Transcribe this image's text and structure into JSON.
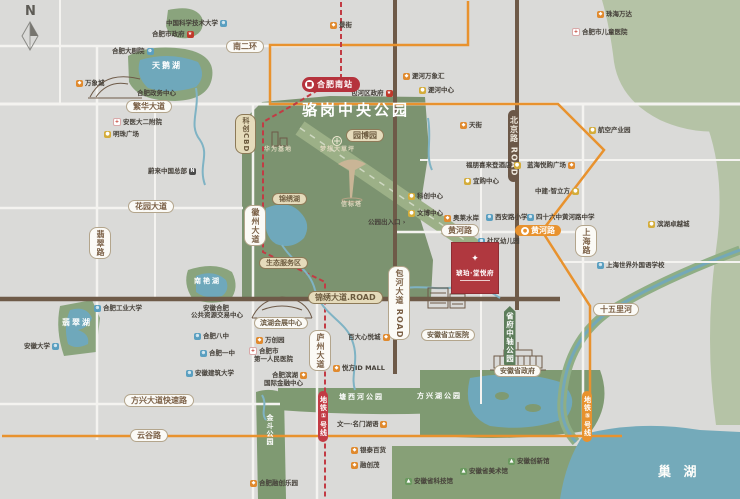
{
  "compass": {
    "letter": "N"
  },
  "station": {
    "name": "合肥南站"
  },
  "project": {
    "name": "琥珀·堂悦府"
  },
  "metro": {
    "line1_label": "地铁①号线",
    "line5_label": "地铁⑤号线"
  },
  "colors": {
    "background": "#dadad8",
    "park_green": "#7c9370",
    "light_green": "#b5c3a6",
    "water_teal": "#6fa8bb",
    "road_brown": "#6e5a48",
    "road_white": "#f4f3f0",
    "metro_red": "#c23b44",
    "metro_orange": "#e8922e",
    "badge_red": "#b5323c"
  },
  "labels": [
    {
      "name": "park-title-luogang",
      "kind": "park-title",
      "text": "骆岗中央公园",
      "x": 302,
      "y": 103
    },
    {
      "name": "lake-name-swan",
      "kind": "water",
      "text": "天鹅湖",
      "x": 152,
      "y": 62
    },
    {
      "name": "lake-name-feicui",
      "kind": "water",
      "text": "翡翠湖",
      "x": 62,
      "y": 319
    },
    {
      "name": "lake-name-nanyan",
      "kind": "water",
      "text": "南艳湖",
      "x": 194,
      "y": 278,
      "fs": 7
    },
    {
      "name": "lake-name-chaohu",
      "kind": "water-big",
      "text": "巢 湖",
      "x": 658,
      "y": 466
    },
    {
      "name": "park-name-tangxihe",
      "kind": "water",
      "text": "塘西河公园",
      "x": 339,
      "y": 394,
      "fs": 7
    },
    {
      "name": "park-name-fangxinghu",
      "kind": "water",
      "text": "方兴湖公园",
      "x": 417,
      "y": 393,
      "fs": 7
    },
    {
      "name": "park-name-jindou",
      "kind": "water",
      "text": "金斗公园",
      "x": 266,
      "y": 414,
      "fs": 7,
      "vert": true
    },
    {
      "name": "road-badge-south-2nd-ring",
      "kind": "pill",
      "text": "南二环",
      "x": 226,
      "y": 40
    },
    {
      "name": "road-badge-fanhua-ave",
      "kind": "pill",
      "text": "繁华大道",
      "x": 126,
      "y": 100
    },
    {
      "name": "road-badge-huayuan-ave",
      "kind": "pill",
      "text": "花园大道",
      "x": 128,
      "y": 200
    },
    {
      "name": "road-badge-fangxing-expwy",
      "kind": "pill",
      "text": "方兴大道快速路",
      "x": 124,
      "y": 394
    },
    {
      "name": "road-badge-yungu-rd",
      "kind": "pill",
      "text": "云谷路",
      "x": 130,
      "y": 429
    },
    {
      "name": "road-badge-huanghe-rd",
      "kind": "pill",
      "text": "黄河路",
      "x": 441,
      "y": 224
    },
    {
      "name": "road-badge-shiwuli-river",
      "kind": "pill",
      "text": "十五里河",
      "x": 593,
      "y": 303
    },
    {
      "name": "road-badge-jinxiu-ave",
      "kind": "pill-tan",
      "text": "锦绣大道.ROAD",
      "x": 308,
      "y": 291
    },
    {
      "name": "station-badge-huanghe-rd",
      "kind": "pill-org-h",
      "text": "黄河路",
      "x": 515,
      "y": 225
    },
    {
      "name": "road-badge-feicui-rd",
      "kind": "pill",
      "text": "翡翠路",
      "x": 89,
      "y": 227,
      "vert": true
    },
    {
      "name": "road-badge-huizhou-ave",
      "kind": "pill",
      "text": "徽州大道",
      "x": 244,
      "y": 205,
      "vert": true
    },
    {
      "name": "road-badge-luzhou-ave",
      "kind": "pill",
      "text": "庐州大道",
      "x": 309,
      "y": 330,
      "vert": true
    },
    {
      "name": "road-badge-baohe-ave",
      "kind": "pill",
      "text": "包河大道 ROAD",
      "x": 388,
      "y": 266,
      "vert": true
    },
    {
      "name": "road-badge-beijing-rd",
      "kind": "pill-dark",
      "text": "北京路 ROAD",
      "x": 508,
      "y": 110,
      "vert": true
    },
    {
      "name": "road-badge-shanghai-rd",
      "kind": "pill",
      "text": "上海路",
      "x": 575,
      "y": 225,
      "vert": true
    },
    {
      "name": "area-badge-kechuang-cbd",
      "kind": "pill-tan",
      "text": "科创CBD",
      "x": 235,
      "y": 114,
      "vert": true,
      "fs": 7
    },
    {
      "name": "area-badge-yuanboyuan",
      "kind": "pill-tan",
      "text": "园博园",
      "x": 346,
      "y": 129
    },
    {
      "name": "area-badge-jinxiu-lake",
      "kind": "pill-tan",
      "text": "锦绣湖",
      "x": 272,
      "y": 193,
      "fs": 7
    },
    {
      "name": "area-badge-eco-service",
      "kind": "pill-tan",
      "text": "生态服务区",
      "x": 259,
      "y": 257,
      "fs": 7
    },
    {
      "name": "area-badge-shengfu-axis-park",
      "kind": "pill-green",
      "text": "省府中轴公园",
      "x": 504,
      "y": 306,
      "vert": true
    },
    {
      "name": "metro-line1-label",
      "kind": "pill-red",
      "text": "地铁①号线",
      "x": 318,
      "y": 391,
      "vert": true
    },
    {
      "name": "metro-line5-label",
      "kind": "pill-org",
      "text": "地铁⑤号线",
      "x": 582,
      "y": 391,
      "vert": true
    },
    {
      "name": "lm-binhu-expo-center",
      "kind": "lm-pill",
      "text": "滨湖会展中心",
      "x": 254,
      "y": 317
    },
    {
      "name": "lm-anhui-provincial-hospital",
      "kind": "lm-pill",
      "text": "安徽省立医院",
      "x": 421,
      "y": 329
    },
    {
      "name": "lm-anhui-provincial-gov",
      "kind": "lm-pill",
      "text": "安徽省政府",
      "x": 494,
      "y": 365
    },
    {
      "name": "poi-ustc",
      "kind": "poi",
      "text": "中国科学技术大学",
      "x": 166,
      "y": 20,
      "icon": "school",
      "side": "right"
    },
    {
      "name": "poi-hefei-city-gov",
      "kind": "poi",
      "text": "合肥市政府",
      "x": 152,
      "y": 31,
      "icon": "gov",
      "side": "right"
    },
    {
      "name": "poi-hefei-grand-theater",
      "kind": "poi",
      "text": "合肥大剧院",
      "x": 112,
      "y": 48,
      "icon": "school",
      "side": "right"
    },
    {
      "name": "poi-mixc-mall",
      "kind": "poi",
      "text": "万象城",
      "x": 76,
      "y": 80,
      "icon": "shop"
    },
    {
      "name": "poi-hefei-gov-center",
      "kind": "poi",
      "text": "合肥政务中心",
      "x": 137,
      "y": 90
    },
    {
      "name": "poi-anyi-2nd-hospital",
      "kind": "poi",
      "text": "安医大二附院",
      "x": 113,
      "y": 118,
      "icon": "hospital"
    },
    {
      "name": "poi-mingzhu-square",
      "kind": "poi",
      "text": "明珠广场",
      "x": 104,
      "y": 131,
      "icon": "biz"
    },
    {
      "name": "poi-nio-china-hq",
      "kind": "poi",
      "text": "蔚来中国总部",
      "x": 148,
      "y": 168,
      "icon": "nio",
      "side": "right"
    },
    {
      "name": "poi-jing-street",
      "kind": "poi",
      "text": "景街",
      "x": 330,
      "y": 22,
      "icon": "shop"
    },
    {
      "name": "poi-feihe-mixc",
      "kind": "poi",
      "text": "淝河万象汇",
      "x": 403,
      "y": 73,
      "icon": "shop"
    },
    {
      "name": "poi-feihe-center",
      "kind": "poi",
      "text": "淝河中心",
      "x": 419,
      "y": 87,
      "icon": "biz"
    },
    {
      "name": "poi-baohe-district-gov",
      "kind": "poi",
      "text": "包河区政府",
      "x": 351,
      "y": 90,
      "icon": "gov",
      "side": "right"
    },
    {
      "name": "poi-zhuhai-wanda",
      "kind": "poi",
      "text": "珠海万达",
      "x": 597,
      "y": 11,
      "icon": "shop"
    },
    {
      "name": "poi-children-hospital",
      "kind": "poi",
      "text": "合肥市儿童医院",
      "x": 572,
      "y": 28,
      "icon": "hospital"
    },
    {
      "name": "poi-tianjie-mall",
      "kind": "poi",
      "text": "天街",
      "x": 460,
      "y": 122,
      "icon": "shop"
    },
    {
      "name": "poi-aviation-industry-park",
      "kind": "poi",
      "text": "航空产业园",
      "x": 589,
      "y": 127,
      "icon": "biz"
    },
    {
      "name": "poi-four-points-hotel",
      "kind": "poi",
      "text": "福朋喜来登酒店",
      "x": 466,
      "y": 162,
      "icon": "biz",
      "side": "right"
    },
    {
      "name": "poi-lanhai-yuegou-plaza",
      "kind": "poi",
      "text": "蓝海悦购广场",
      "x": 527,
      "y": 162,
      "icon": "shop",
      "side": "right"
    },
    {
      "name": "poi-yigou-center",
      "kind": "poi",
      "text": "宜购中心",
      "x": 464,
      "y": 178,
      "icon": "biz"
    },
    {
      "name": "poi-kechuang-center",
      "kind": "poi",
      "text": "科创中心",
      "x": 408,
      "y": 193,
      "icon": "biz"
    },
    {
      "name": "poi-wenbo-center",
      "kind": "poi",
      "text": "文博中心",
      "x": 408,
      "y": 210,
      "icon": "biz"
    },
    {
      "name": "poi-zhongjian-zhilifang",
      "kind": "poi",
      "text": "中建·智立方",
      "x": 535,
      "y": 188,
      "icon": "biz",
      "side": "right"
    },
    {
      "name": "poi-xianlu-primary-school",
      "kind": "poi",
      "text": "西安路小学",
      "x": 486,
      "y": 214,
      "icon": "school"
    },
    {
      "name": "poi-46th-middle-school",
      "kind": "poi",
      "text": "四十六中黄河路中学",
      "x": 527,
      "y": 214,
      "icon": "school"
    },
    {
      "name": "poi-aolai-shuian",
      "kind": "poi",
      "text": "奥莱水岸",
      "x": 444,
      "y": 215,
      "icon": "shop"
    },
    {
      "name": "poi-community-kindergarten",
      "kind": "poi",
      "text": "社区幼儿园",
      "x": 478,
      "y": 238,
      "icon": "school"
    },
    {
      "name": "poi-binhu-excellence-city",
      "kind": "poi",
      "text": "滨湖卓越城",
      "x": 648,
      "y": 221,
      "icon": "biz"
    },
    {
      "name": "poi-shanghai-foreign-school",
      "kind": "poi",
      "text": "上海世界外国语学校",
      "x": 597,
      "y": 262,
      "icon": "school"
    },
    {
      "name": "poi-park-entrance",
      "kind": "poi",
      "text": "公园出入口 ›",
      "x": 368,
      "y": 219
    },
    {
      "name": "poi-hefei-tech-university",
      "kind": "poi",
      "text": "合肥工业大学",
      "x": 94,
      "y": 305,
      "icon": "school"
    },
    {
      "name": "poi-anhui-university",
      "kind": "poi",
      "text": "安徽大学",
      "x": 24,
      "y": 343,
      "icon": "school",
      "side": "right"
    },
    {
      "name": "poi-resource-center-line1",
      "kind": "poi-line",
      "text": "安徽合肥",
      "x": 203,
      "y": 305
    },
    {
      "name": "poi-resource-center-line2",
      "kind": "poi-line",
      "text": "公共资源交易中心",
      "x": 191,
      "y": 312
    },
    {
      "name": "poi-hefei-8th-school",
      "kind": "poi",
      "text": "合肥八中",
      "x": 194,
      "y": 333,
      "icon": "school"
    },
    {
      "name": "poi-hefei-1st-school",
      "kind": "poi",
      "text": "合肥一中",
      "x": 200,
      "y": 350,
      "icon": "school"
    },
    {
      "name": "poi-anhui-jianzhu-university",
      "kind": "poi",
      "text": "安徽建筑大学",
      "x": 186,
      "y": 370,
      "icon": "school"
    },
    {
      "name": "poi-wanchuang-park",
      "kind": "poi",
      "text": "万创园",
      "x": 256,
      "y": 337,
      "icon": "shop"
    },
    {
      "name": "poi-first-people-hospital-line1",
      "kind": "poi",
      "text": "合肥市",
      "x": 249,
      "y": 347,
      "icon": "hospital"
    },
    {
      "name": "poi-first-people-hospital-line2",
      "kind": "poi-line",
      "text": "第一人民医院",
      "x": 254,
      "y": 356
    },
    {
      "name": "poi-binhu-ifc-line1",
      "kind": "poi",
      "text": "合肥滨湖",
      "x": 272,
      "y": 372,
      "icon": "shop",
      "side": "right"
    },
    {
      "name": "poi-binhu-ifc-line2",
      "kind": "poi-line",
      "text": "国际金融中心",
      "x": 264,
      "y": 380
    },
    {
      "name": "poi-baida-xinyuecheng",
      "kind": "poi",
      "text": "百大心悦城",
      "x": 348,
      "y": 334,
      "icon": "shop",
      "side": "right"
    },
    {
      "name": "poi-yuefang-id-mall",
      "kind": "poi",
      "text": "悦方ID MALL",
      "x": 333,
      "y": 365,
      "icon": "shop"
    },
    {
      "name": "poi-wenyi-mingmen",
      "kind": "poi",
      "text": "文一·名门湖语",
      "x": 337,
      "y": 421,
      "icon": "shop",
      "side": "right"
    },
    {
      "name": "poi-yintai-dept-store",
      "kind": "poi",
      "text": "银泰百货",
      "x": 351,
      "y": 447,
      "icon": "shop"
    },
    {
      "name": "poi-rongchuang-mall",
      "kind": "poi",
      "text": "融创茂",
      "x": 351,
      "y": 462,
      "icon": "shop"
    },
    {
      "name": "poi-hefei-sunac-land",
      "kind": "poi",
      "text": "合肥融创乐园",
      "x": 250,
      "y": 480,
      "icon": "shop"
    },
    {
      "name": "poi-anhui-innovation-hall",
      "kind": "poi",
      "text": "安徽创新馆",
      "x": 508,
      "y": 458,
      "icon": "museum"
    },
    {
      "name": "poi-anhui-art-museum",
      "kind": "poi",
      "text": "安徽省美术馆",
      "x": 460,
      "y": 468,
      "icon": "museum"
    },
    {
      "name": "poi-anhui-science-museum",
      "kind": "poi",
      "text": "安徽省科技馆",
      "x": 405,
      "y": 478,
      "icon": "museum"
    },
    {
      "name": "park-poi-huawei-base",
      "kind": "park-small",
      "text": "华为基地",
      "x": 264,
      "y": 147
    },
    {
      "name": "park-poi-dream-lawn",
      "kind": "park-small",
      "text": "梦想大草坪",
      "x": 320,
      "y": 147
    },
    {
      "name": "park-poi-beacon-tower",
      "kind": "park-small",
      "text": "信标塔",
      "x": 341,
      "y": 202
    }
  ]
}
